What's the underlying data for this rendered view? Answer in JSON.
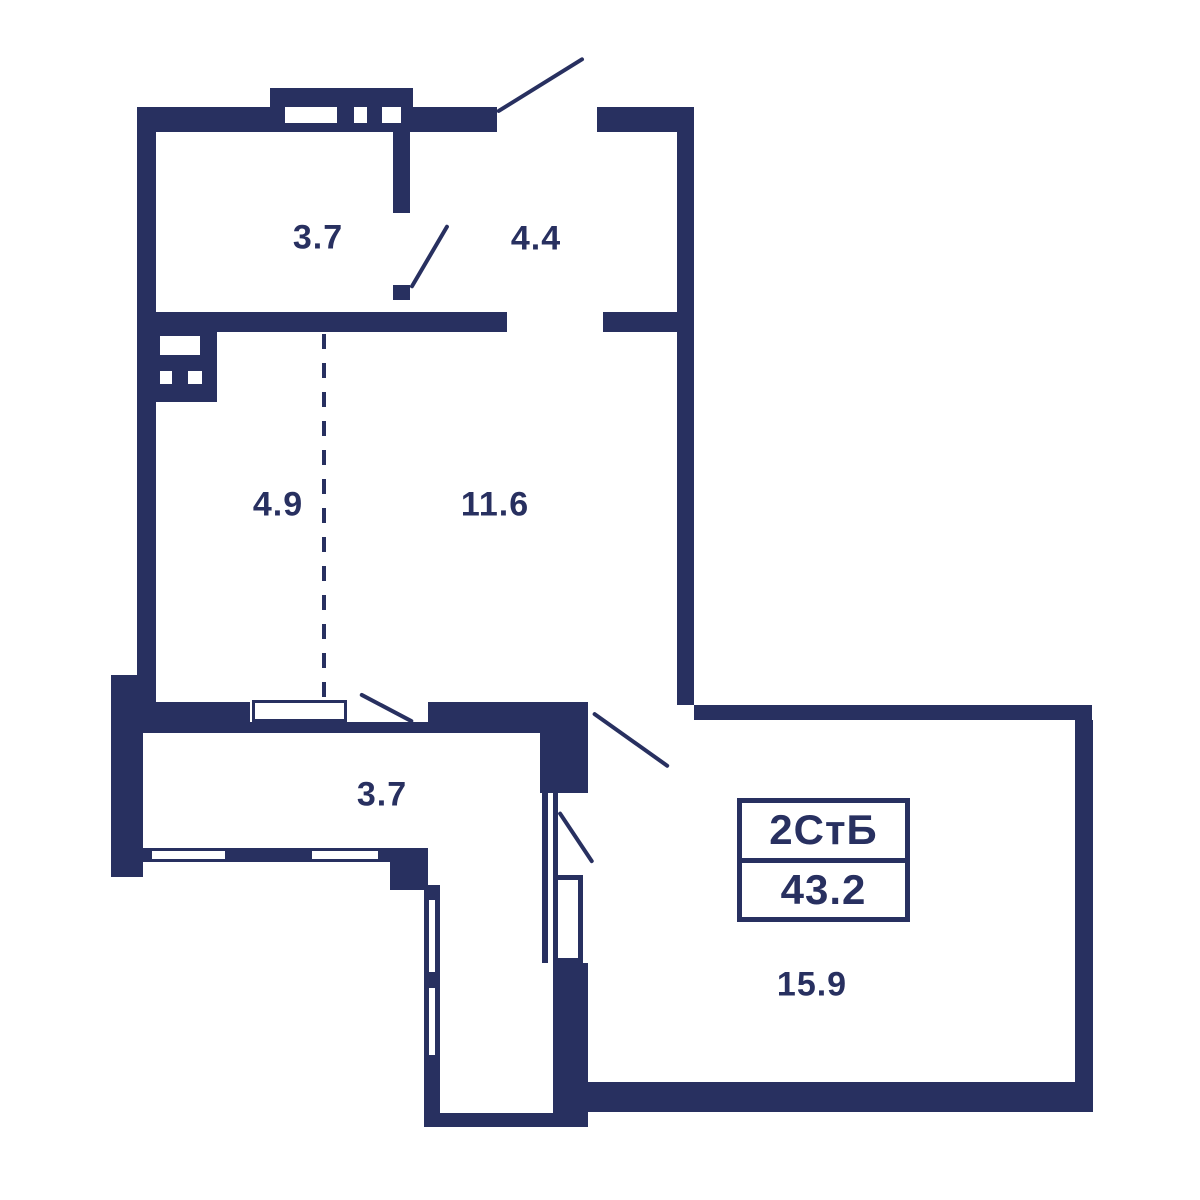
{
  "plan": {
    "type_label": "2СтБ",
    "total_area": "43.2",
    "rooms": [
      {
        "name": "room-3.7-top",
        "area": "3.7"
      },
      {
        "name": "room-4.4",
        "area": "4.4"
      },
      {
        "name": "room-4.9",
        "area": "4.9"
      },
      {
        "name": "room-11.6",
        "area": "11.6"
      },
      {
        "name": "room-3.7-bottom",
        "area": "3.7"
      },
      {
        "name": "room-15.9",
        "area": "15.9"
      }
    ],
    "colors": {
      "wall": "#283060",
      "background": "#ffffff"
    }
  }
}
